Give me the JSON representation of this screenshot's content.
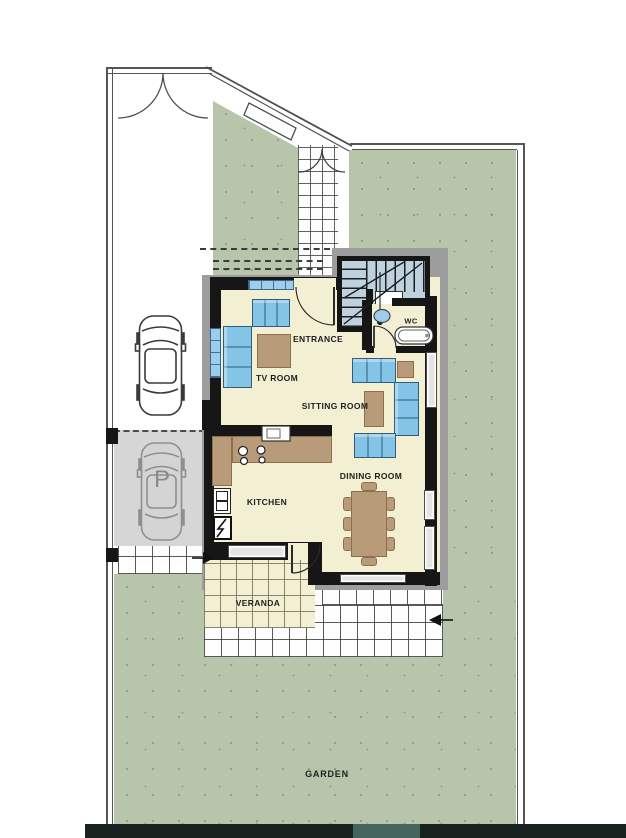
{
  "labels": {
    "entrance": "ENTRANCE",
    "tv_room": "TV ROOM",
    "sitting_room": "SITTING ROOM",
    "dining_room": "DINING ROOM",
    "kitchen": "KITCHEN",
    "wc": "WC",
    "veranda": "VERANDA",
    "garden": "GARDEN",
    "parking": "P"
  },
  "colors": {
    "garden": "#b7c6ab",
    "floor": "#f3efd3",
    "wall": "#161616",
    "band": "#9d9d9d",
    "sofa": "#84c4e6",
    "sofa_line": "#2e5d7d",
    "tan": "#b89c79",
    "stair": "#bdd2de",
    "parking": "#d6d6d6",
    "win_blue": "#9dcdeb",
    "strip": "#182320",
    "strip_light": "#44645c"
  }
}
